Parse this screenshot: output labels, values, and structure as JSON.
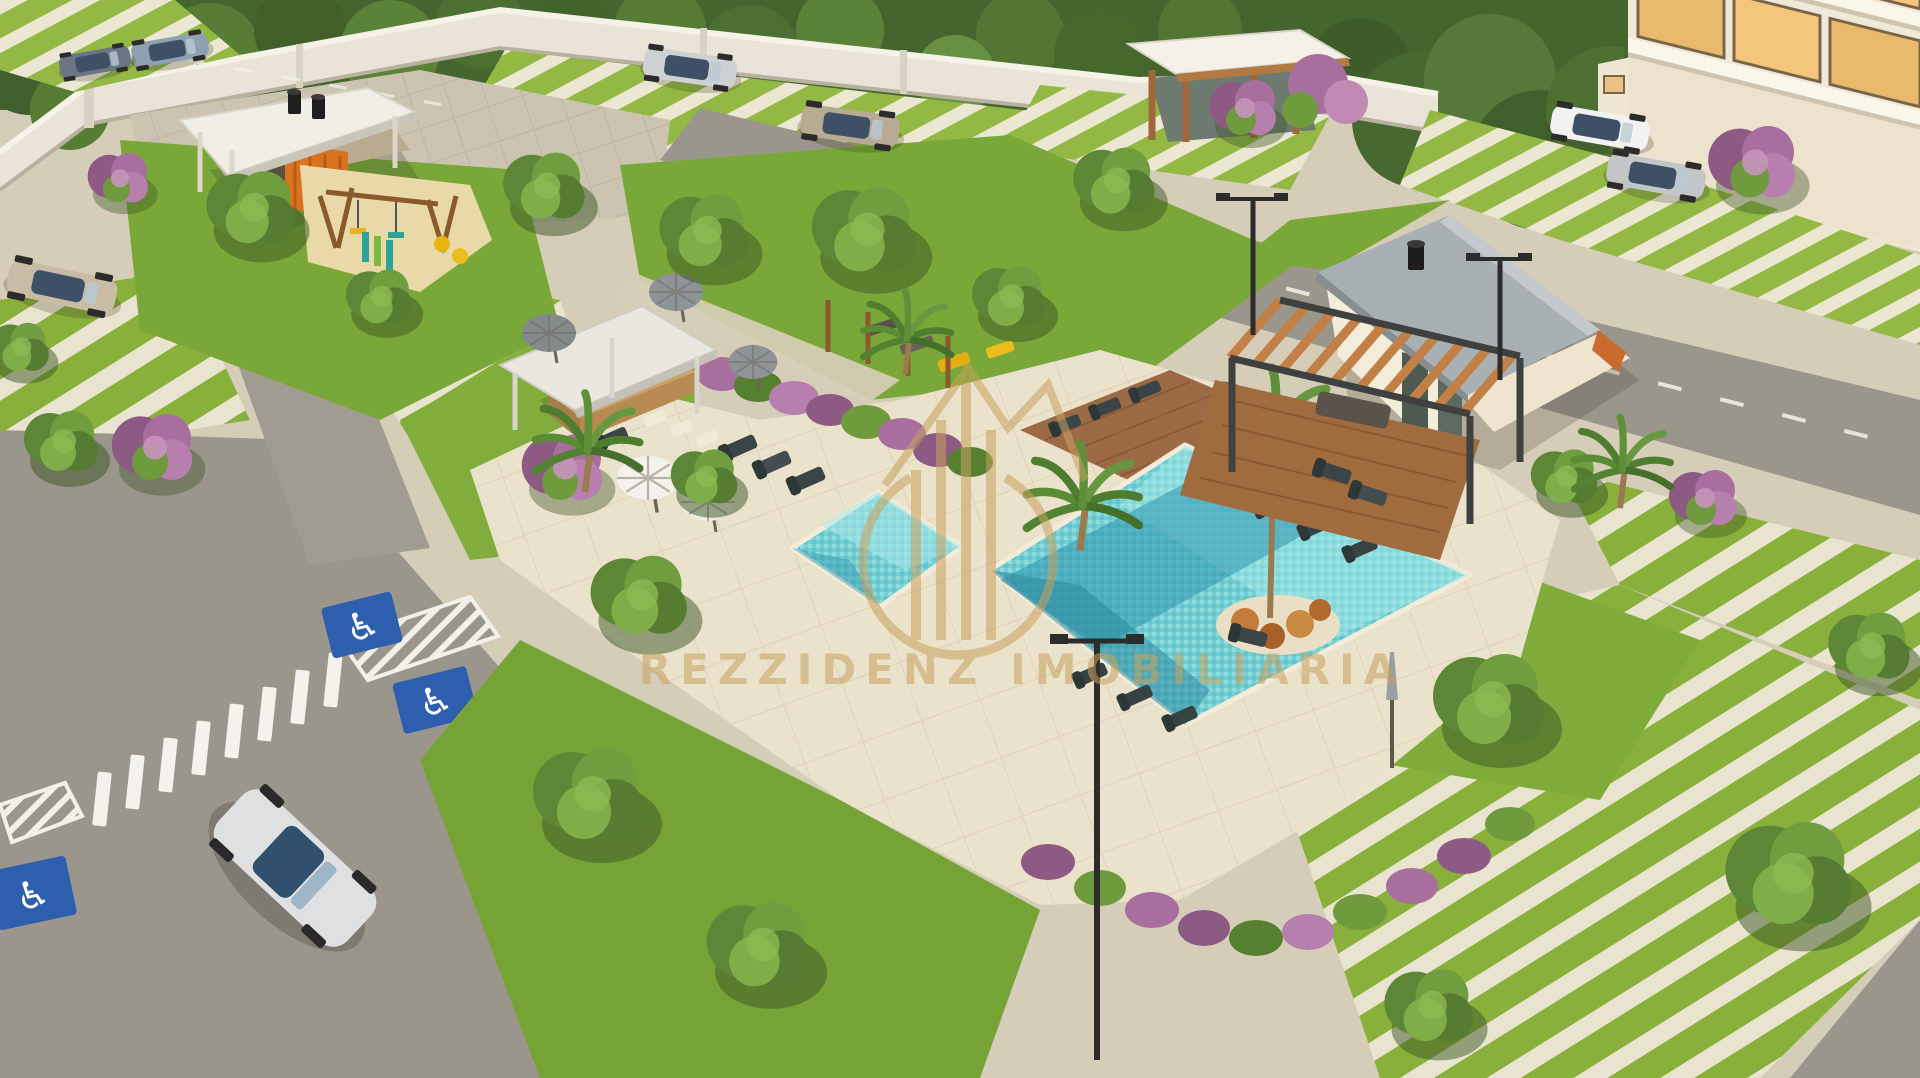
{
  "image": {
    "type": "architectural-aerial-render",
    "subject": "Aerial render of a residential condominium leisure area: two swimming pools with palm islands, pool house with pergola, bar kiosk with umbrellas, playground, gym pavilion, landscaped grass-striped parking lots, roads with crosswalk and accessible parking markings"
  },
  "watermark": {
    "text": "REZZIDENZ IMOBILIARIA",
    "logo": "skyline-in-circle-emblem",
    "color": "#c8a15f"
  },
  "icons": {
    "wheelchair": "♿"
  },
  "palette": {
    "tree_canopy": "#46682c",
    "lawn": "#7aa838",
    "grass_stripe": "#8ab03c",
    "paver_stripe": "#e9e4cf",
    "ground": "#d6cdb9",
    "pool_deck": "#ebe2cb",
    "pool_shallow": "#8fdcdd",
    "pool_deep": "#2f96ad",
    "road": "#9b968c",
    "wall": "#e9e4d7",
    "accessible_blue": "#2e5fae",
    "wood": "#b5793f",
    "play_orange": "#d8731f",
    "flower_purple": "#a86f9e",
    "window_glow": "#f2c67c",
    "watermark_gold": "#c8a15f"
  },
  "counts": {
    "pools": 2,
    "cars": 8,
    "palm_trees": 5,
    "umbrellas": 6,
    "accessible_parking_markings": 3,
    "light_poles": 3,
    "crosswalk_bars": 8
  },
  "structures": [
    "gym-pavilion",
    "playground",
    "bar-kiosk",
    "entrance-gazebo",
    "pool-house-with-pergola",
    "apartment-building",
    "perimeter-wall"
  ]
}
